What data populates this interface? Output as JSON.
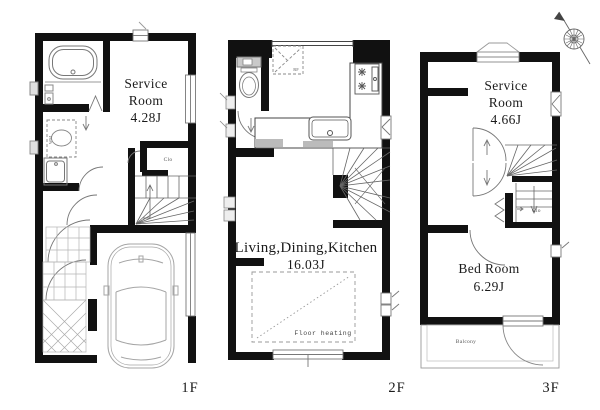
{
  "colors": {
    "wall": "#111111",
    "fixture_line": "#808080",
    "light_line": "#b5b5b5",
    "text": "#1b1b1b"
  },
  "floors": {
    "f1": {
      "label": "1F",
      "service_room": {
        "line1": "Service",
        "line2": "Room",
        "area": "4.28J"
      },
      "closet_label": "Clo",
      "washing_machine_label": "WM"
    },
    "f2": {
      "label": "2F",
      "ldk": {
        "name": "Living,Dining,Kitchen",
        "area": "16.03J"
      },
      "refrigerator_label": "RF",
      "floor_heating_label": "Floor heating"
    },
    "f3": {
      "label": "3F",
      "service_room": {
        "line1": "Service",
        "line2": "Room",
        "area": "4.66J"
      },
      "bed_room": {
        "name": "Bed Room",
        "area": "6.29J"
      },
      "closet_label": "Clo",
      "balcony_label": "Balcony"
    }
  }
}
